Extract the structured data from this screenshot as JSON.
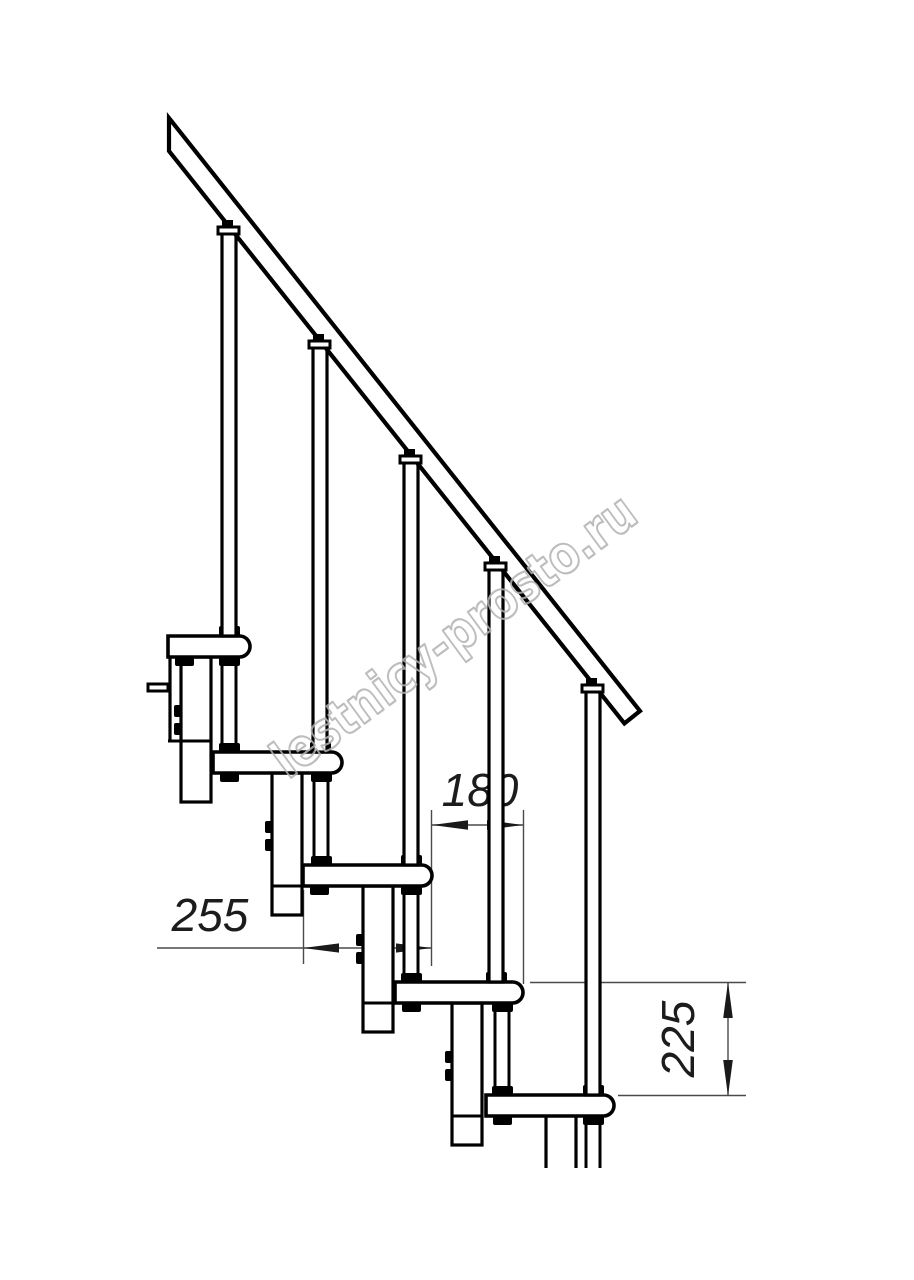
{
  "drawing": {
    "title": "staircase-fragment-side-view",
    "watermark": {
      "text": "lestnicy-prosto.ru",
      "color": "#b2b2b2"
    },
    "dimensions": {
      "going": {
        "value": "180",
        "orientation": "horizontal"
      },
      "tread_depth": {
        "value": "255",
        "orientation": "horizontal"
      },
      "riser_height": {
        "value": "225",
        "orientation": "vertical"
      }
    },
    "colors": {
      "line": "#000000",
      "dimension_line": "#4a4a4a",
      "dimension_text": "#1c1c1c",
      "background": "#ffffff"
    }
  }
}
